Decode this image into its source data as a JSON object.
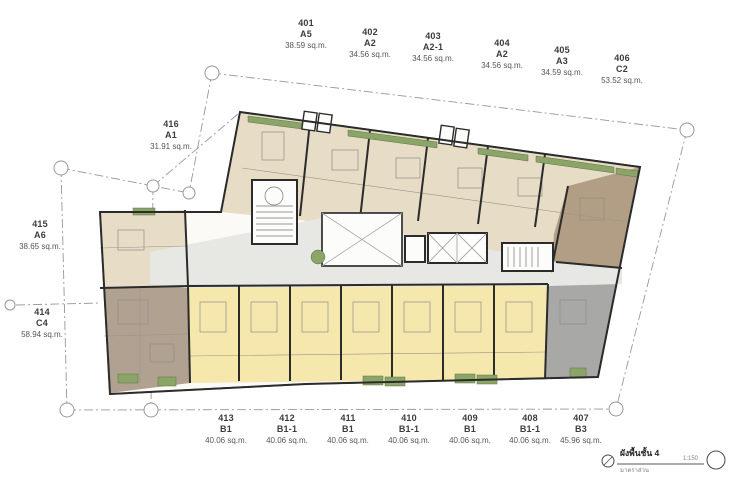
{
  "page": {
    "background": "#ffffff",
    "kind": "architectural floor plan"
  },
  "palette": {
    "wall": "#2b2b2b",
    "boundary": "#979797",
    "base": "#fbfaf7",
    "tan": "#e7ddc7",
    "yellow": "#f6e8ad",
    "taupe": "#b0a190",
    "brown": "#b29e84",
    "gray_unit": "#a8a8a6",
    "corridor": "#e7e7e4",
    "green": "#8ba568",
    "core_fill": "#fcfcfb",
    "text_dark": "#3c3c3c",
    "text_muted": "#565656"
  },
  "units": [
    {
      "no": "401",
      "type": "A5",
      "area": "38.59 sq.m."
    },
    {
      "no": "402",
      "type": "A2",
      "area": "34.56 sq.m."
    },
    {
      "no": "403",
      "type": "A2-1",
      "area": "34.56 sq.m."
    },
    {
      "no": "404",
      "type": "A2",
      "area": "34.56 sq.m."
    },
    {
      "no": "405",
      "type": "A3",
      "area": "34.59 sq.m."
    },
    {
      "no": "406",
      "type": "C2",
      "area": "53.52 sq.m."
    },
    {
      "no": "407",
      "type": "B3",
      "area": "45.96 sq.m."
    },
    {
      "no": "408",
      "type": "B1-1",
      "area": "40.06 sq.m."
    },
    {
      "no": "409",
      "type": "B1",
      "area": "40.06 sq.m."
    },
    {
      "no": "410",
      "type": "B1-1",
      "area": "40.06 sq.m."
    },
    {
      "no": "411",
      "type": "B1",
      "area": "40.06 sq.m."
    },
    {
      "no": "412",
      "type": "B1-1",
      "area": "40.06 sq.m."
    },
    {
      "no": "413",
      "type": "B1",
      "area": "40.06 sq.m."
    },
    {
      "no": "414",
      "type": "C4",
      "area": "58.94 sq.m."
    },
    {
      "no": "415",
      "type": "A6",
      "area": "38.65 sq.m."
    },
    {
      "no": "416",
      "type": "A1",
      "area": "31.91 sq.m."
    }
  ],
  "title_block": {
    "title": "ผังพื้นชั้น 4",
    "subtitle": "มาตราส่วน",
    "scale": "1:150"
  }
}
